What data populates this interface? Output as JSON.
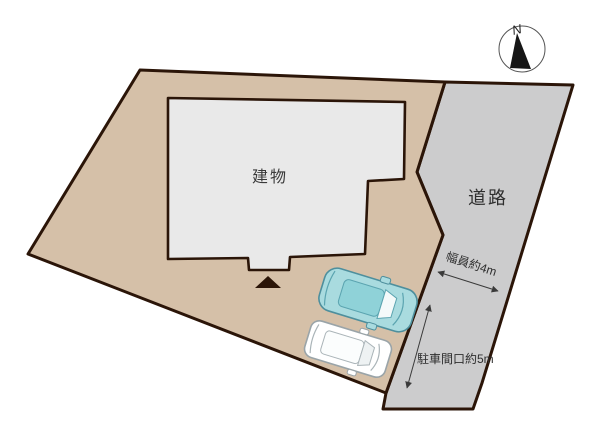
{
  "diagram": {
    "type": "real-estate-site-plan",
    "labels": {
      "building": "建物",
      "road": "道路",
      "compass_north": "N"
    },
    "annotations": {
      "road_width": "幅員約4m",
      "parking_frontage": "駐車間口約5m"
    },
    "colors": {
      "background": "#ffffff",
      "land": "#d5c0a8",
      "road": "#cccccd",
      "building": "#e9e9e9",
      "outline": "#2b1508",
      "marker": "#2b1508",
      "annotation": "#3a3a3a",
      "car_teal_body": "#a9dbdf",
      "car_teal_roof": "#8fd2d8",
      "car_teal_stroke": "#4e8f9d",
      "car_white_body": "#ffffff",
      "car_white_stroke": "#9aa4a8",
      "glass_white": "#f4fafa"
    }
  }
}
